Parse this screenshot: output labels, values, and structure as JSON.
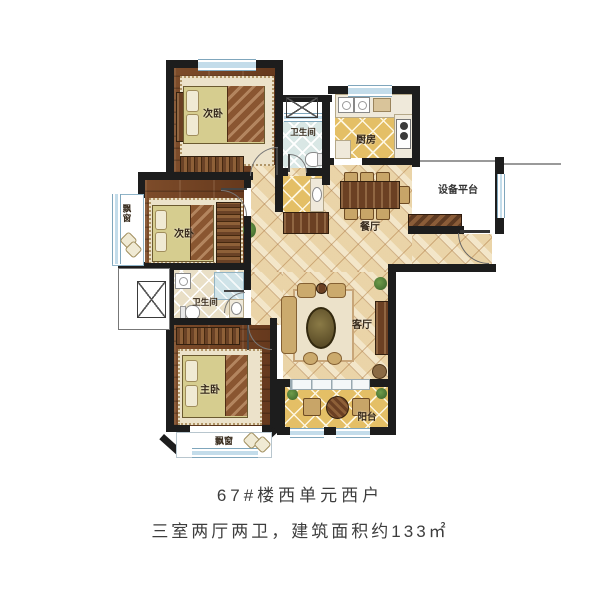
{
  "title": {
    "line1": "67#楼西单元西户",
    "line2": "三室两厅两卫，建筑面积约133㎡"
  },
  "rooms": {
    "bedroom_top": {
      "label": "次卧"
    },
    "bath_top": {
      "label": "卫生间"
    },
    "kitchen": {
      "label": "厨房"
    },
    "equipment_platform": {
      "label": "设备平台"
    },
    "dining": {
      "label": "餐厅"
    },
    "bedroom_mid": {
      "label": "次卧"
    },
    "bath_mid": {
      "label": "卫生间"
    },
    "master_bedroom": {
      "label": "主卧"
    },
    "living": {
      "label": "客厅"
    },
    "balcony": {
      "label": "阳台"
    },
    "bay_window_left": {
      "label": "飘窗"
    },
    "bay_window_bottom": {
      "label": "飘窗"
    }
  },
  "colors": {
    "wall": "#1d1d1d",
    "wood_floor": "#754526",
    "tile_floor": "#eedcb4",
    "gold_tile": "#e4bf66",
    "bath_tile": "#d9e7e5",
    "window_blue": "#c3dcea",
    "caption_text": "#3d3d3d",
    "label_text": "#35281a"
  }
}
